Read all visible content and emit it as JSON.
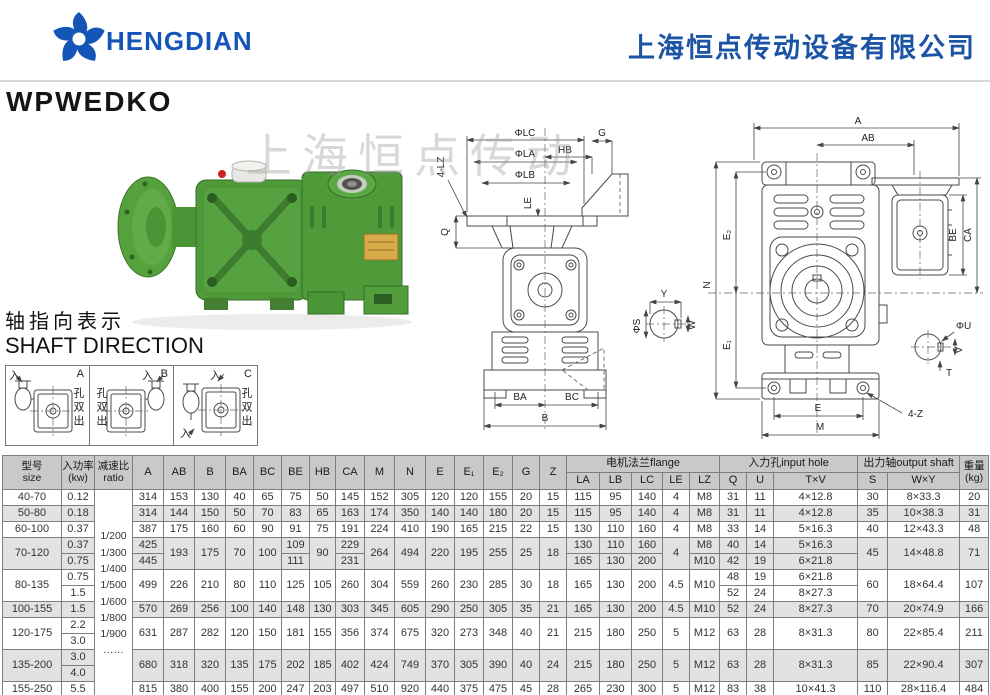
{
  "colors": {
    "brand_blue": "#1456b8",
    "company_blue": "#1b53a5",
    "body_green": "#4f9a39",
    "table_header_gray": "#c9c9c9",
    "row_shade_gray": "#e2e2e2"
  },
  "header": {
    "brand": "HENGDIAN",
    "company": "上海恒点传动设备有限公司"
  },
  "page_title": "WPWEDKO",
  "watermark": "上海恒点传动",
  "shaft_direction": {
    "title_zh": "轴指向表示",
    "title_en": "SHAFT DIRECTION",
    "variants": [
      {
        "label": "A",
        "input": "入",
        "output": "孔双出"
      },
      {
        "label": "B",
        "input": "入",
        "output": "孔双出"
      },
      {
        "label": "C",
        "input": "入",
        "input2": "入",
        "output": "孔双出"
      }
    ]
  },
  "drawings": {
    "front": {
      "lz4": "4-LZ",
      "lc": "ΦLC",
      "la": "ΦLA",
      "lb": "ΦLB",
      "hb": "HB",
      "g": "G",
      "le": "LE",
      "q": "Q",
      "ba": "BA",
      "bc": "BC",
      "b": "B"
    },
    "input_detail": {
      "s": "ΦS",
      "y": "Y",
      "w": "W"
    },
    "side": {
      "a": "A",
      "ab": "AB",
      "be": "BE",
      "ca": "CA",
      "e2": "E₂",
      "n": "N",
      "e1": "E₁",
      "e": "E",
      "m": "M",
      "z4": "4-Z"
    },
    "output_detail": {
      "u": "ΦU",
      "v": "V",
      "t": "T"
    }
  },
  "table": {
    "header": {
      "size": "型号\nsize",
      "power": "入功率\n(kw)",
      "ratio": "减速比\nratio",
      "dims": [
        "A",
        "AB",
        "B",
        "BA",
        "BC",
        "BE",
        "HB",
        "CA",
        "M",
        "N",
        "E",
        "E₁",
        "E₂",
        "G",
        "Z"
      ],
      "flange_group": "电机法兰flange",
      "flange_cols": [
        "LA",
        "LB",
        "LC",
        "LE",
        "LZ"
      ],
      "input_group": "入力孔input hole",
      "input_cols": [
        "Q",
        "U",
        "T×V"
      ],
      "output_group": "出力轴output shaft",
      "output_cols": [
        "S",
        "W×Y"
      ],
      "weight": "重量\n(kg)"
    },
    "ratio_values": [
      "1/200",
      "1/300",
      "1/400",
      "1/500",
      "1/600",
      "1/800",
      "1/900",
      "……"
    ],
    "col_keys": [
      "A",
      "AB",
      "B",
      "BA",
      "BC",
      "BE",
      "HB",
      "CA",
      "M",
      "N",
      "E",
      "E1",
      "E2",
      "G",
      "Z",
      "LA",
      "LB",
      "LC",
      "LE",
      "LZ",
      "Q",
      "U",
      "TV",
      "S",
      "WY",
      "KG"
    ],
    "groups": [
      {
        "size": "40-70",
        "power": "0.12",
        "A": "314",
        "AB": "153",
        "B": "130",
        "BA": "40",
        "BC": "65",
        "BE": "75",
        "HB": "50",
        "CA": "145",
        "M": "152",
        "N": "305",
        "E": "120",
        "E1": "120",
        "E2": "155",
        "G": "20",
        "Z": "15",
        "LA": "115",
        "LB": "95",
        "LC": "140",
        "LE": "4",
        "LZ": "M8",
        "Q": "31",
        "U": "11",
        "TV": "4×12.8",
        "S": "30",
        "WY": "8×33.3",
        "KG": "20"
      },
      {
        "size": "50-80",
        "power": "0.18",
        "A": "314",
        "AB": "144",
        "B": "150",
        "BA": "50",
        "BC": "70",
        "BE": "83",
        "HB": "65",
        "CA": "163",
        "M": "174",
        "N": "350",
        "E": "140",
        "E1": "140",
        "E2": "180",
        "G": "20",
        "Z": "15",
        "LA": "115",
        "LB": "95",
        "LC": "140",
        "LE": "4",
        "LZ": "M8",
        "Q": "31",
        "U": "11",
        "TV": "4×12.8",
        "S": "35",
        "WY": "10×38.3",
        "KG": "31"
      },
      {
        "size": "60-100",
        "power": "0.37",
        "A": "387",
        "AB": "175",
        "B": "160",
        "BA": "60",
        "BC": "90",
        "BE": "91",
        "HB": "75",
        "CA": "191",
        "M": "224",
        "N": "410",
        "E": "190",
        "E1": "165",
        "E2": "215",
        "G": "22",
        "Z": "15",
        "LA": "130",
        "LB": "110",
        "LC": "160",
        "LE": "4",
        "LZ": "M8",
        "Q": "33",
        "U": "14",
        "TV": "5×16.3",
        "S": "40",
        "WY": "12×43.3",
        "KG": "48"
      },
      {
        "size": "70-120",
        "power": [
          "0.37",
          "0.75"
        ],
        "A": [
          "425",
          "445"
        ],
        "AB": "193",
        "B": "175",
        "BA": "70",
        "BC": "100",
        "BE": [
          "109",
          "111"
        ],
        "HB": "90",
        "CA": [
          "229",
          "231"
        ],
        "M": "264",
        "N": "494",
        "E": "220",
        "E1": "195",
        "E2": "255",
        "G": "25",
        "Z": "18",
        "LA": [
          "130",
          "165"
        ],
        "LB": [
          "110",
          "130"
        ],
        "LC": [
          "160",
          "200"
        ],
        "LE": "4",
        "LZ": [
          "M8",
          "M10"
        ],
        "Q": [
          "40",
          "42"
        ],
        "U": [
          "14",
          "19"
        ],
        "TV": [
          "5×16.3",
          "6×21.8"
        ],
        "S": "45",
        "WY": "14×48.8",
        "KG": "71"
      },
      {
        "size": "80-135",
        "power": [
          "0.75",
          "1.5"
        ],
        "A": "499",
        "AB": "226",
        "B": "210",
        "BA": "80",
        "BC": "110",
        "BE": "125",
        "HB": "105",
        "CA": "260",
        "M": "304",
        "N": "559",
        "E": "260",
        "E1": "230",
        "E2": "285",
        "G": "30",
        "Z": "18",
        "LA": "165",
        "LB": "130",
        "LC": "200",
        "LE": "4.5",
        "LZ": "M10",
        "Q": [
          "48",
          "52"
        ],
        "U": [
          "19",
          "24"
        ],
        "TV": [
          "6×21.8",
          "8×27.3"
        ],
        "S": "60",
        "WY": "18×64.4",
        "KG": "107"
      },
      {
        "size": "100-155",
        "power": "1.5",
        "A": "570",
        "AB": "269",
        "B": "256",
        "BA": "100",
        "BC": "140",
        "BE": "148",
        "HB": "130",
        "CA": "303",
        "M": "345",
        "N": "605",
        "E": "290",
        "E1": "250",
        "E2": "305",
        "G": "35",
        "Z": "21",
        "LA": "165",
        "LB": "130",
        "LC": "200",
        "LE": "4.5",
        "LZ": "M10",
        "Q": "52",
        "U": "24",
        "TV": "8×27.3",
        "S": "70",
        "WY": "20×74.9",
        "KG": "166"
      },
      {
        "size": "120-175",
        "power": [
          "2.2",
          "3.0"
        ],
        "A": "631",
        "AB": "287",
        "B": "282",
        "BA": "120",
        "BC": "150",
        "BE": "181",
        "HB": "155",
        "CA": "356",
        "M": "374",
        "N": "675",
        "E": "320",
        "E1": "273",
        "E2": "348",
        "G": "40",
        "Z": "21",
        "LA": "215",
        "LB": "180",
        "LC": "250",
        "LE": "5",
        "LZ": "M12",
        "Q": "63",
        "U": "28",
        "TV": "8×31.3",
        "S": "80",
        "WY": "22×85.4",
        "KG": "211"
      },
      {
        "size": "135-200",
        "power": [
          "3.0",
          "4.0"
        ],
        "A": "680",
        "AB": "318",
        "B": "320",
        "BA": "135",
        "BC": "175",
        "BE": "202",
        "HB": "185",
        "CA": "402",
        "M": "424",
        "N": "749",
        "E": "370",
        "E1": "305",
        "E2": "390",
        "G": "40",
        "Z": "24",
        "LA": "215",
        "LB": "180",
        "LC": "250",
        "LE": "5",
        "LZ": "M12",
        "Q": "63",
        "U": "28",
        "TV": "8×31.3",
        "S": "85",
        "WY": "22×90.4",
        "KG": "307"
      },
      {
        "size": "155-250",
        "power": "5.5",
        "A": "815",
        "AB": "380",
        "B": "400",
        "BA": "155",
        "BC": "200",
        "BE": "247",
        "HB": "203",
        "CA": "497",
        "M": "510",
        "N": "920",
        "E": "440",
        "E1": "375",
        "E2": "475",
        "G": "45",
        "Z": "28",
        "LA": "265",
        "LB": "230",
        "LC": "300",
        "LE": "5",
        "LZ": "M12",
        "Q": "83",
        "U": "38",
        "TV": "10×41.3",
        "S": "110",
        "WY": "28×116.4",
        "KG": "484"
      }
    ]
  }
}
